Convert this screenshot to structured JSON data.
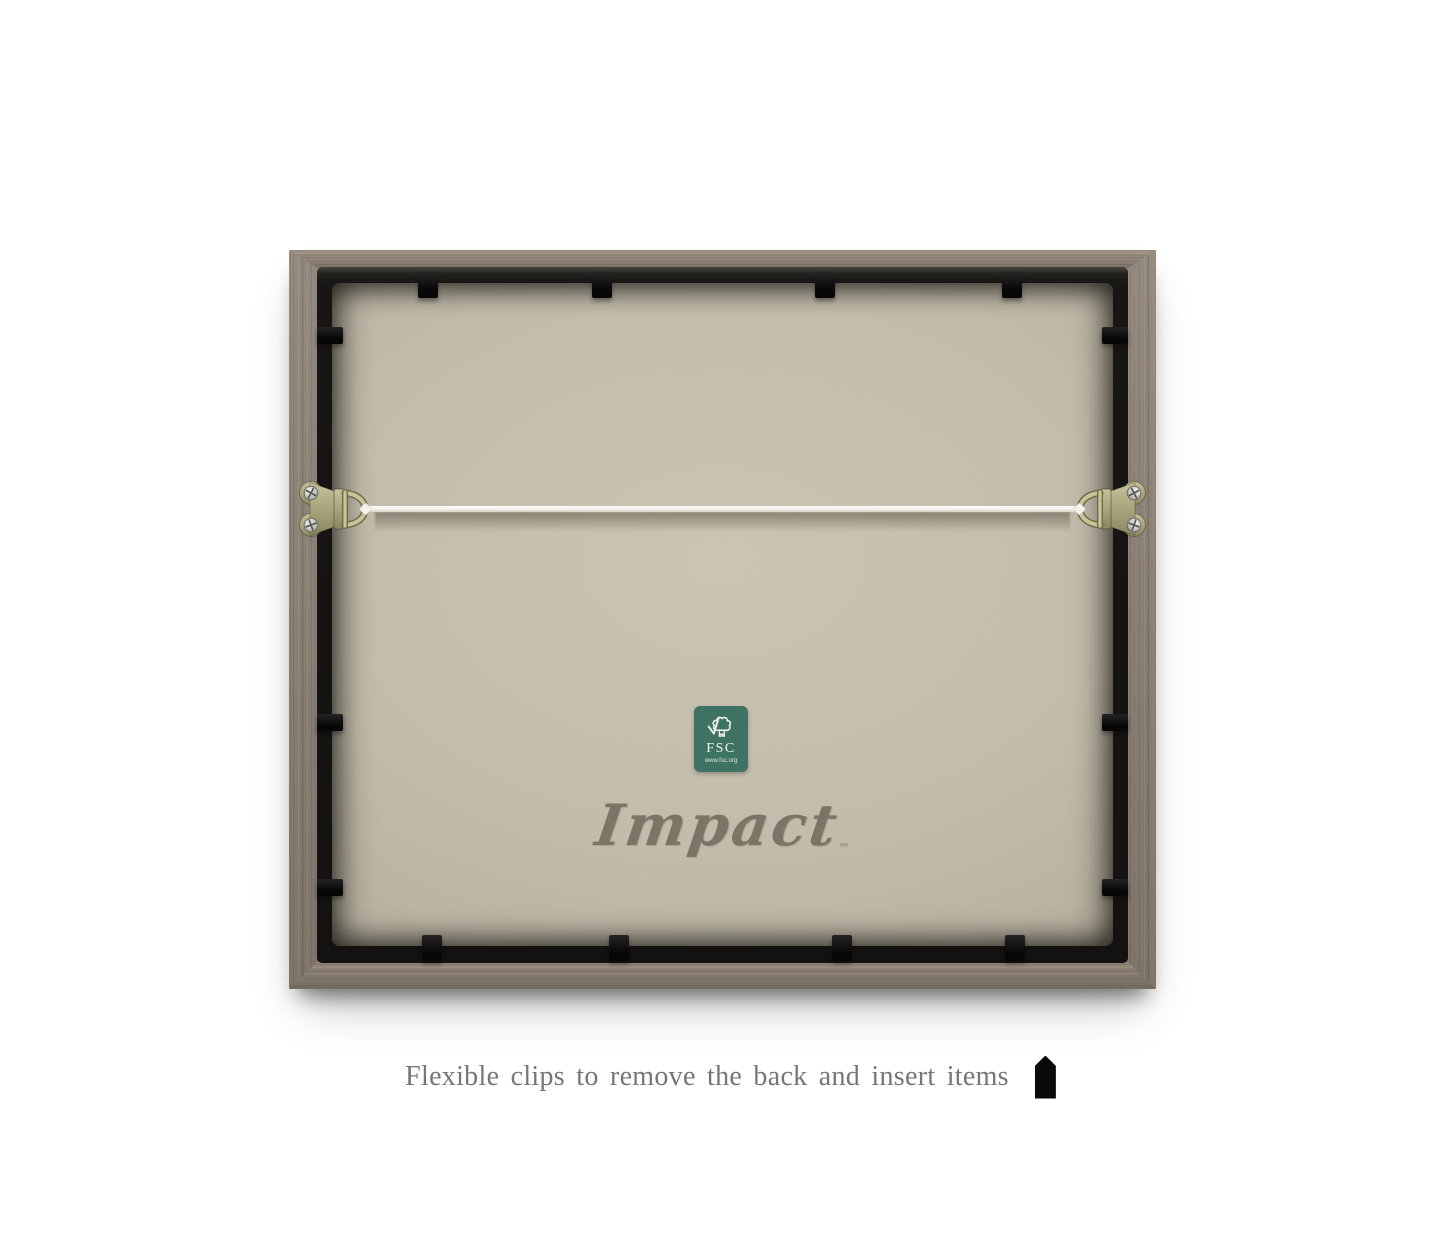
{
  "scene": {
    "type": "product-photo",
    "subject": "Back view of a wooden picture frame",
    "background_color": "#ffffff"
  },
  "frame": {
    "wood_color": "#8d8174",
    "wood_highlight": "#a89b8e",
    "wood_shadow": "#6f655b",
    "inner_frame_color": "#171615",
    "backing_color": "#c2bcac",
    "clip_color": "#0b0b0b",
    "clip_counts": {
      "top": 4,
      "bottom": 4,
      "left": 3,
      "right": 3
    },
    "clips": {
      "top_x": [
        129,
        303,
        526,
        713
      ],
      "bottom_x": [
        133,
        320,
        543,
        716
      ],
      "left_y": [
        77,
        464,
        629
      ],
      "right_y": [
        77,
        464,
        629
      ]
    }
  },
  "hardware": {
    "wire_color": "#f3f2ec",
    "hanger_plate_color": "#aba77e",
    "ring_color": "#c9c59a",
    "screw_color": "#d6d6d4"
  },
  "fsc_label": {
    "background_color": "#3e7363",
    "title": "FSC",
    "url": "www.fsc.org",
    "icon": "fsc-tree-checkmark-icon"
  },
  "brand": {
    "name": "Impact",
    "trademark": "™",
    "color": "#7c7466"
  },
  "caption": {
    "text": "Flexible clips to remove the back and insert items",
    "color": "#767676",
    "icon": "flexible-clip-icon"
  }
}
